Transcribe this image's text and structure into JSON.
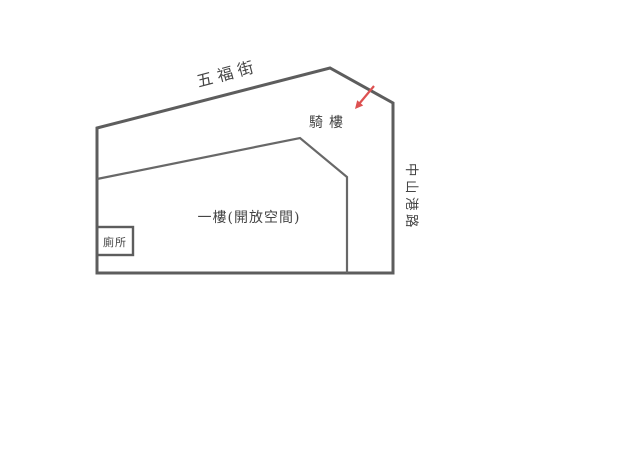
{
  "diagram": {
    "type": "floor-plan",
    "colors": {
      "wall": "#5d5d5d",
      "inner_line": "#686868",
      "arrow": "#dd5151",
      "text": "#454545",
      "background": "#ffffff"
    },
    "labels": {
      "street_top": "五福街",
      "arcade": "騎樓",
      "first_floor": "一樓(開放空間)",
      "toilet": "廁所",
      "street_right": "中山港路"
    },
    "icons": {
      "entrance_arrow": "red-arrow-pointing-down-left"
    }
  }
}
